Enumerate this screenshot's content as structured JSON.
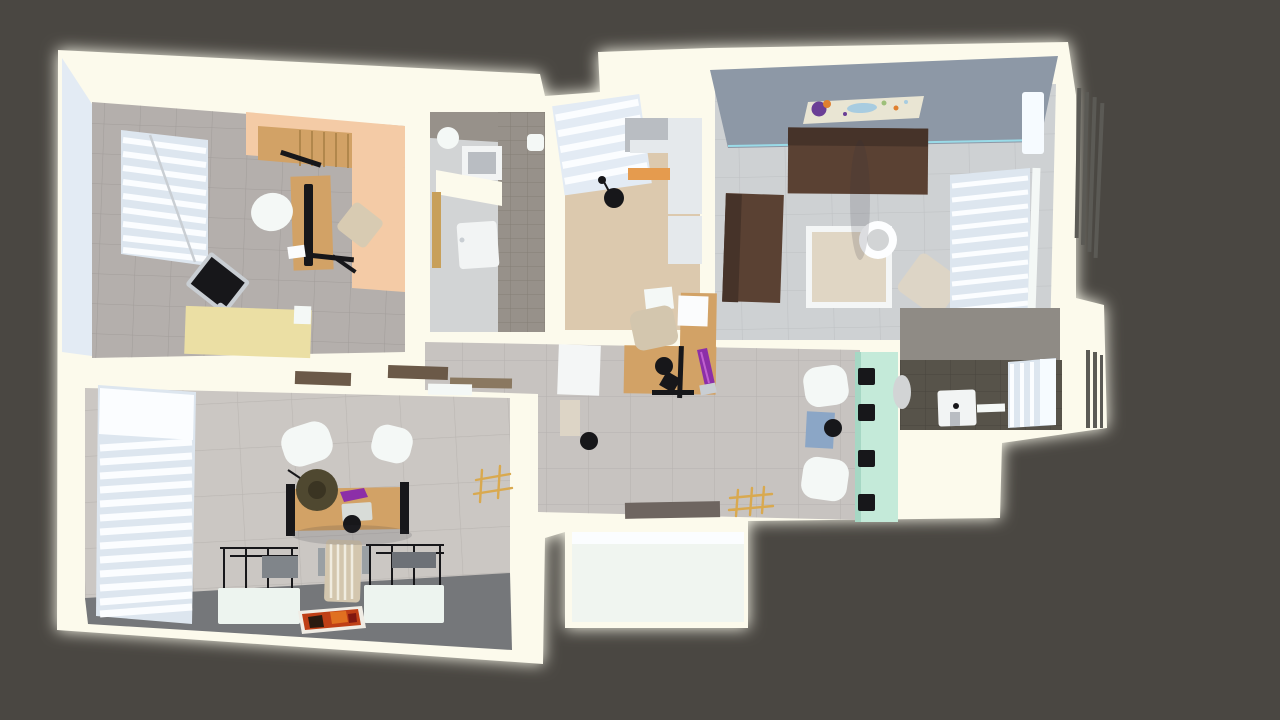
{
  "viewer": {
    "type": "3d-floor-plan-top-view-render",
    "description": "Photorealistic top-down 3D rendering of a furnished apartment floor plan on a dark gray backdrop"
  },
  "palette": {
    "bg": "#4a4742",
    "glow": "#fffef0",
    "wall": "#fcfaec",
    "wallface": "#e3ebf4",
    "officeFloor": "#b4afac",
    "officeTileLine": "#a29d9a",
    "peach": "#f4cba6",
    "wood": "#d2a266",
    "woodStep": "#b1874c",
    "cream": "#ebdfa4",
    "nearBlack": "#17171a",
    "silver": "#c9ced3",
    "chairWhite": "#f4f8f6",
    "beigeChair": "#d8cbb2",
    "blindBase": "#dde6ef",
    "blindSlat": "#fbfdff",
    "bathFloor": "#d2d4d5",
    "bathTile": "#97918a",
    "bathTileLine": "#847e76",
    "doorTan": "#c8a05a",
    "kitchenFloor": "#dcc9ae",
    "cabinetGray": "#b9bdc2",
    "cabinetWhite": "#e5e9ec",
    "orangeAccent": "#e59b4e",
    "livingFloor": "#ced1d3",
    "livingTileLine": "#bec1c3",
    "accentWall": "#8d98a6",
    "tealLine": "#9adbe8",
    "paintingBg": "#e9e5d3",
    "paintPurple": "#6b3f96",
    "paintOrange": "#e08030",
    "paintBlue": "#a8cce0",
    "paintGreen": "#9ec07a",
    "sofa": "#5a4133",
    "sofaDark": "#463329",
    "tableFrame": "#f4f6f6",
    "tableTop": "#e0d6c4",
    "lampWhite": "#fdfeff",
    "ottoman": "#ddd5c6",
    "hallFloor": "#c7c3c0",
    "hallTileLine": "#b6b2af",
    "mint": "#c4ead9",
    "mintShade": "#a6d7c4",
    "blueDesk": "#8ba6c6",
    "screenBlue": "#4f6f9e",
    "matGray": "#6e6560",
    "gold": "#d9a94f",
    "darkBathFloor": "#57534a",
    "darkBathLine": "#49463e",
    "midTile": "#8f8b85",
    "sinkWhite": "#f2f4f4",
    "windowPane": "#f6fbff",
    "louverDark": "#5b5a55",
    "roomWallTile": "#cbc7c3",
    "roomWallTileLine": "#bab6b2",
    "roomDarkFloor": "#75777a",
    "beamBrown": "#6b5948",
    "beamBrown2": "#8a7860",
    "olive": "#4f4830",
    "oliveDark": "#3a3422",
    "purple": "#8c2fa8",
    "typewriter": "#d8dcd8",
    "chairTan": "#d3c6ae",
    "chairArm": "#9aa0a4",
    "deskWhite": "#edf4ef",
    "panelGray": "#80858a",
    "panelGray2": "#6d7177",
    "rugOrange": "#bf3f16",
    "rugDark": "#e07020",
    "rugBlack": "#2a1a10",
    "porch": "#f0f5f0",
    "paper": "#fbfcfd"
  },
  "scene": {
    "rooms": [
      {
        "id": "office",
        "label": "office with wood platform, L-desk, monitors and cream sideboard"
      },
      {
        "id": "bathroom",
        "label": "bathroom with shower, washbasin, round mirror and tiled wall"
      },
      {
        "id": "kitchen",
        "label": "kitchen with gray cabinets, orange accent and black pendant lamp"
      },
      {
        "id": "living-room",
        "label": "living room with abstract painting, brown sofas, coffee table and ottoman"
      },
      {
        "id": "hallway",
        "label": "hallway with wooden workstation, lounge chairs and mint media wall"
      },
      {
        "id": "washroom",
        "label": "small washroom with basin, oval mirror and window"
      },
      {
        "id": "studio",
        "label": "large studio with window blinds, wooden desk, wireframe desks and rug"
      },
      {
        "id": "porch",
        "label": "entry porch"
      }
    ]
  }
}
